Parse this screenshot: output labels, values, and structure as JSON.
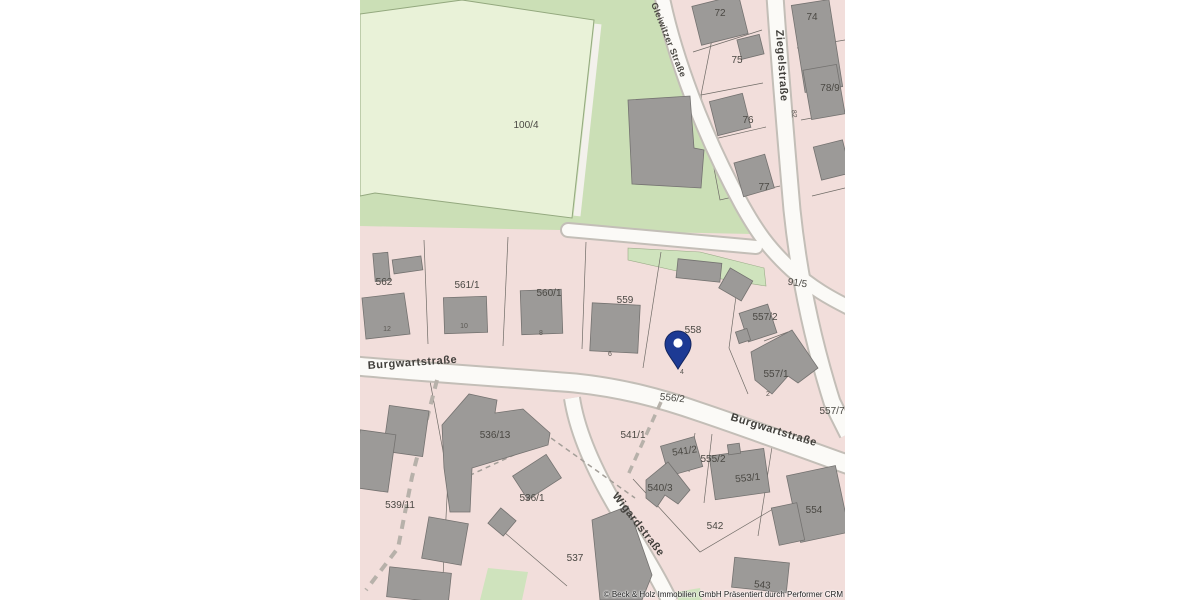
{
  "map": {
    "attribution": "© Beck & Holz Immobilien GmbH Präsentiert durch Performer CRM",
    "marker": {
      "name": "location-pin",
      "color": "#1d3a94"
    },
    "colors": {
      "parcel_pink": "#f2dedb",
      "green_outer": "#cbdfb6",
      "green_field": "#e9f2d8",
      "road_fill": "#fbfaf7",
      "road_casing": "#c3beb7",
      "building_gray": "#9c9a98",
      "pin_blue": "#1d3a94"
    },
    "streets": [
      "Burgwartstraße",
      "Ziegelstraße",
      "Gleiwitzer Straße",
      "Wigardstraße"
    ],
    "labels": [
      {
        "text": "100/4",
        "x": 166,
        "y": 128,
        "rot": 0,
        "type": "parcel"
      },
      {
        "text": "72",
        "x": 360,
        "y": 16,
        "rot": 0,
        "type": "parcel"
      },
      {
        "text": "74",
        "x": 452,
        "y": 20,
        "rot": 0,
        "type": "parcel"
      },
      {
        "text": "75",
        "x": 377,
        "y": 63,
        "rot": 0,
        "type": "parcel"
      },
      {
        "text": "76",
        "x": 388,
        "y": 123,
        "rot": 0,
        "type": "parcel"
      },
      {
        "text": "78/9",
        "x": 470,
        "y": 91,
        "rot": 0,
        "type": "parcel"
      },
      {
        "text": "77",
        "x": 404,
        "y": 190,
        "rot": 0,
        "type": "parcel"
      },
      {
        "text": "91/5",
        "x": 437,
        "y": 286,
        "rot": 8,
        "type": "parcel"
      },
      {
        "text": "562",
        "x": 24,
        "y": 285,
        "rot": 0,
        "type": "parcel"
      },
      {
        "text": "561/1",
        "x": 107,
        "y": 288,
        "rot": 0,
        "type": "parcel"
      },
      {
        "text": "560/1",
        "x": 189,
        "y": 296,
        "rot": 0,
        "type": "parcel"
      },
      {
        "text": "559",
        "x": 265,
        "y": 303,
        "rot": 0,
        "type": "parcel"
      },
      {
        "text": "558",
        "x": 333,
        "y": 333,
        "rot": 0,
        "type": "parcel"
      },
      {
        "text": "557/2",
        "x": 405,
        "y": 320,
        "rot": 0,
        "type": "parcel"
      },
      {
        "text": "557/1",
        "x": 416,
        "y": 377,
        "rot": 0,
        "type": "parcel"
      },
      {
        "text": "557/7",
        "x": 472,
        "y": 414,
        "rot": 0,
        "type": "parcel"
      },
      {
        "text": "556/2",
        "x": 312,
        "y": 401,
        "rot": 6,
        "type": "parcel"
      },
      {
        "text": "541/1",
        "x": 273,
        "y": 438,
        "rot": 0,
        "type": "parcel"
      },
      {
        "text": "541/2",
        "x": 325,
        "y": 454,
        "rot": -8,
        "type": "parcel"
      },
      {
        "text": "555/2",
        "x": 353,
        "y": 462,
        "rot": 0,
        "type": "parcel"
      },
      {
        "text": "540/3",
        "x": 300,
        "y": 491,
        "rot": 0,
        "type": "parcel"
      },
      {
        "text": "553/1",
        "x": 388,
        "y": 481,
        "rot": -6,
        "type": "parcel"
      },
      {
        "text": "554",
        "x": 454,
        "y": 513,
        "rot": 0,
        "type": "parcel"
      },
      {
        "text": "542",
        "x": 355,
        "y": 529,
        "rot": 0,
        "type": "parcel"
      },
      {
        "text": "543",
        "x": 402,
        "y": 588,
        "rot": 6,
        "type": "parcel"
      },
      {
        "text": "536/13",
        "x": 135,
        "y": 438,
        "rot": 0,
        "type": "parcel"
      },
      {
        "text": "536/1",
        "x": 172,
        "y": 501,
        "rot": 0,
        "type": "parcel"
      },
      {
        "text": "537",
        "x": 215,
        "y": 561,
        "rot": 0,
        "type": "parcel"
      },
      {
        "text": "539/11",
        "x": 40,
        "y": 508,
        "rot": 0,
        "type": "parcel"
      },
      {
        "text": "12",
        "x": 27,
        "y": 331,
        "rot": 0,
        "type": "house"
      },
      {
        "text": "10",
        "x": 104,
        "y": 328,
        "rot": 0,
        "type": "house"
      },
      {
        "text": "8",
        "x": 181,
        "y": 335,
        "rot": 0,
        "type": "house"
      },
      {
        "text": "6",
        "x": 250,
        "y": 356,
        "rot": 0,
        "type": "house"
      },
      {
        "text": "4",
        "x": 322,
        "y": 374,
        "rot": 0,
        "type": "house"
      },
      {
        "text": "2",
        "x": 408,
        "y": 396,
        "rot": 0,
        "type": "house"
      },
      {
        "text": "82",
        "x": 432,
        "y": 114,
        "rot": 85,
        "type": "house"
      },
      {
        "text": "Burgwartstraße",
        "x": 8,
        "y": 369,
        "rot": -4,
        "type": "street"
      },
      {
        "text": "Burgwartstraße",
        "x": 370,
        "y": 420,
        "rot": 17,
        "type": "street"
      },
      {
        "text": "Ziegelstraße",
        "x": 416,
        "y": 30,
        "rot": 86,
        "type": "street"
      },
      {
        "text": "Wigardstraße",
        "x": 252,
        "y": 496,
        "rot": 52,
        "type": "street"
      },
      {
        "text": "Gleiwitzer Straße",
        "x": 291,
        "y": 4,
        "rot": 68,
        "type": "street-sm"
      }
    ]
  }
}
